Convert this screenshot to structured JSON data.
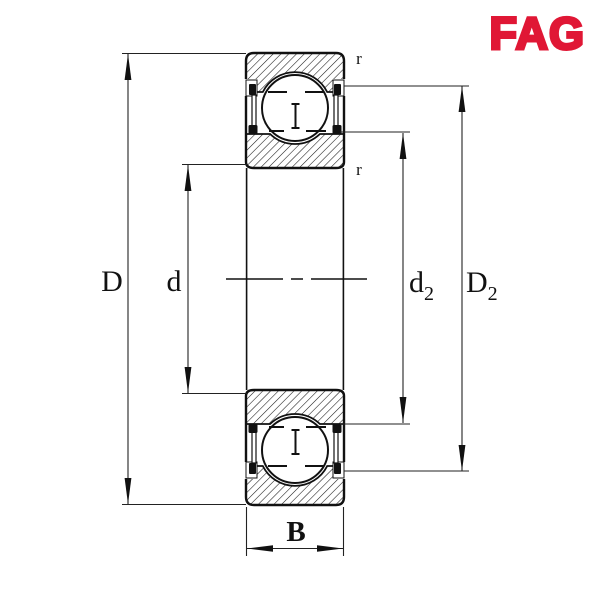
{
  "logo": {
    "text": "FAG",
    "color": "#e01735"
  },
  "drawing": {
    "subject": "deep-groove ball bearing cross-section, shielded both sides",
    "line_color": "#1a1a1a",
    "background": "#ffffff"
  },
  "labels": {
    "D": "D",
    "d": "d",
    "d2_base": "d",
    "d2_sub": "2",
    "D2_base": "D",
    "D2_sub": "2",
    "B": "B",
    "r_top": "r",
    "r_bottom": "r"
  }
}
